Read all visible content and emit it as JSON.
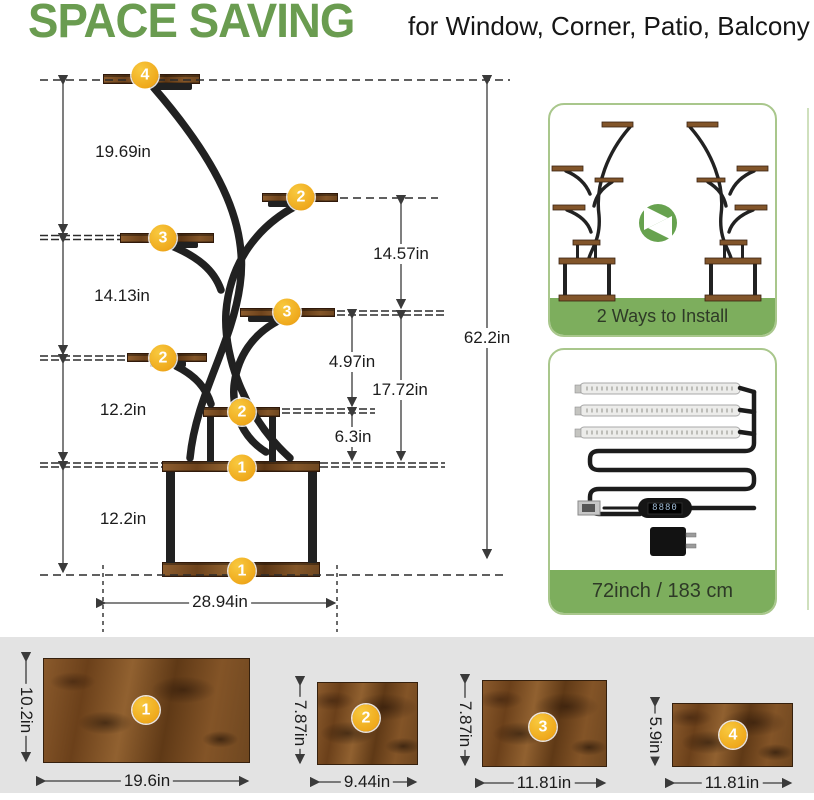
{
  "header": {
    "title": "SPACE SAVING",
    "subtitle": "for Window, Corner, Patio, Balcony"
  },
  "diagram": {
    "badges": {
      "shelf4": "4",
      "shelf2_right": "2",
      "shelf3_left": "3",
      "shelf3_right": "3",
      "shelf2_left": "2",
      "shelf2_center": "2",
      "shelf1_top": "1",
      "shelf1_bottom": "1"
    },
    "dims": {
      "left_top": "19.69in",
      "left_upper": "14.13in",
      "left_mid": "12.2in",
      "left_lower": "12.2in",
      "mid_upper": "14.57in",
      "mid_small": "4.97in",
      "mid_lower": "17.72in",
      "mid_bottom": "6.3in",
      "total_height": "62.2in",
      "base_width": "28.94in"
    }
  },
  "cards": {
    "install": {
      "caption": "2 Ways to Install"
    },
    "light": {
      "caption": "72inch / 183 cm",
      "controller_display": "8880"
    }
  },
  "boards": [
    {
      "badge": "1",
      "width": "19.6in",
      "height": "10.2in"
    },
    {
      "badge": "2",
      "width": "9.44in",
      "height": "7.87in"
    },
    {
      "badge": "3",
      "width": "11.81in",
      "height": "7.87in"
    },
    {
      "badge": "4",
      "width": "11.81in",
      "height": "5.9in"
    }
  ],
  "colors": {
    "accent_green": "#6a9c50",
    "band_green": "#7dae5d",
    "badge_amber": "#efa91c",
    "wood_brown": "#7d4e22"
  }
}
